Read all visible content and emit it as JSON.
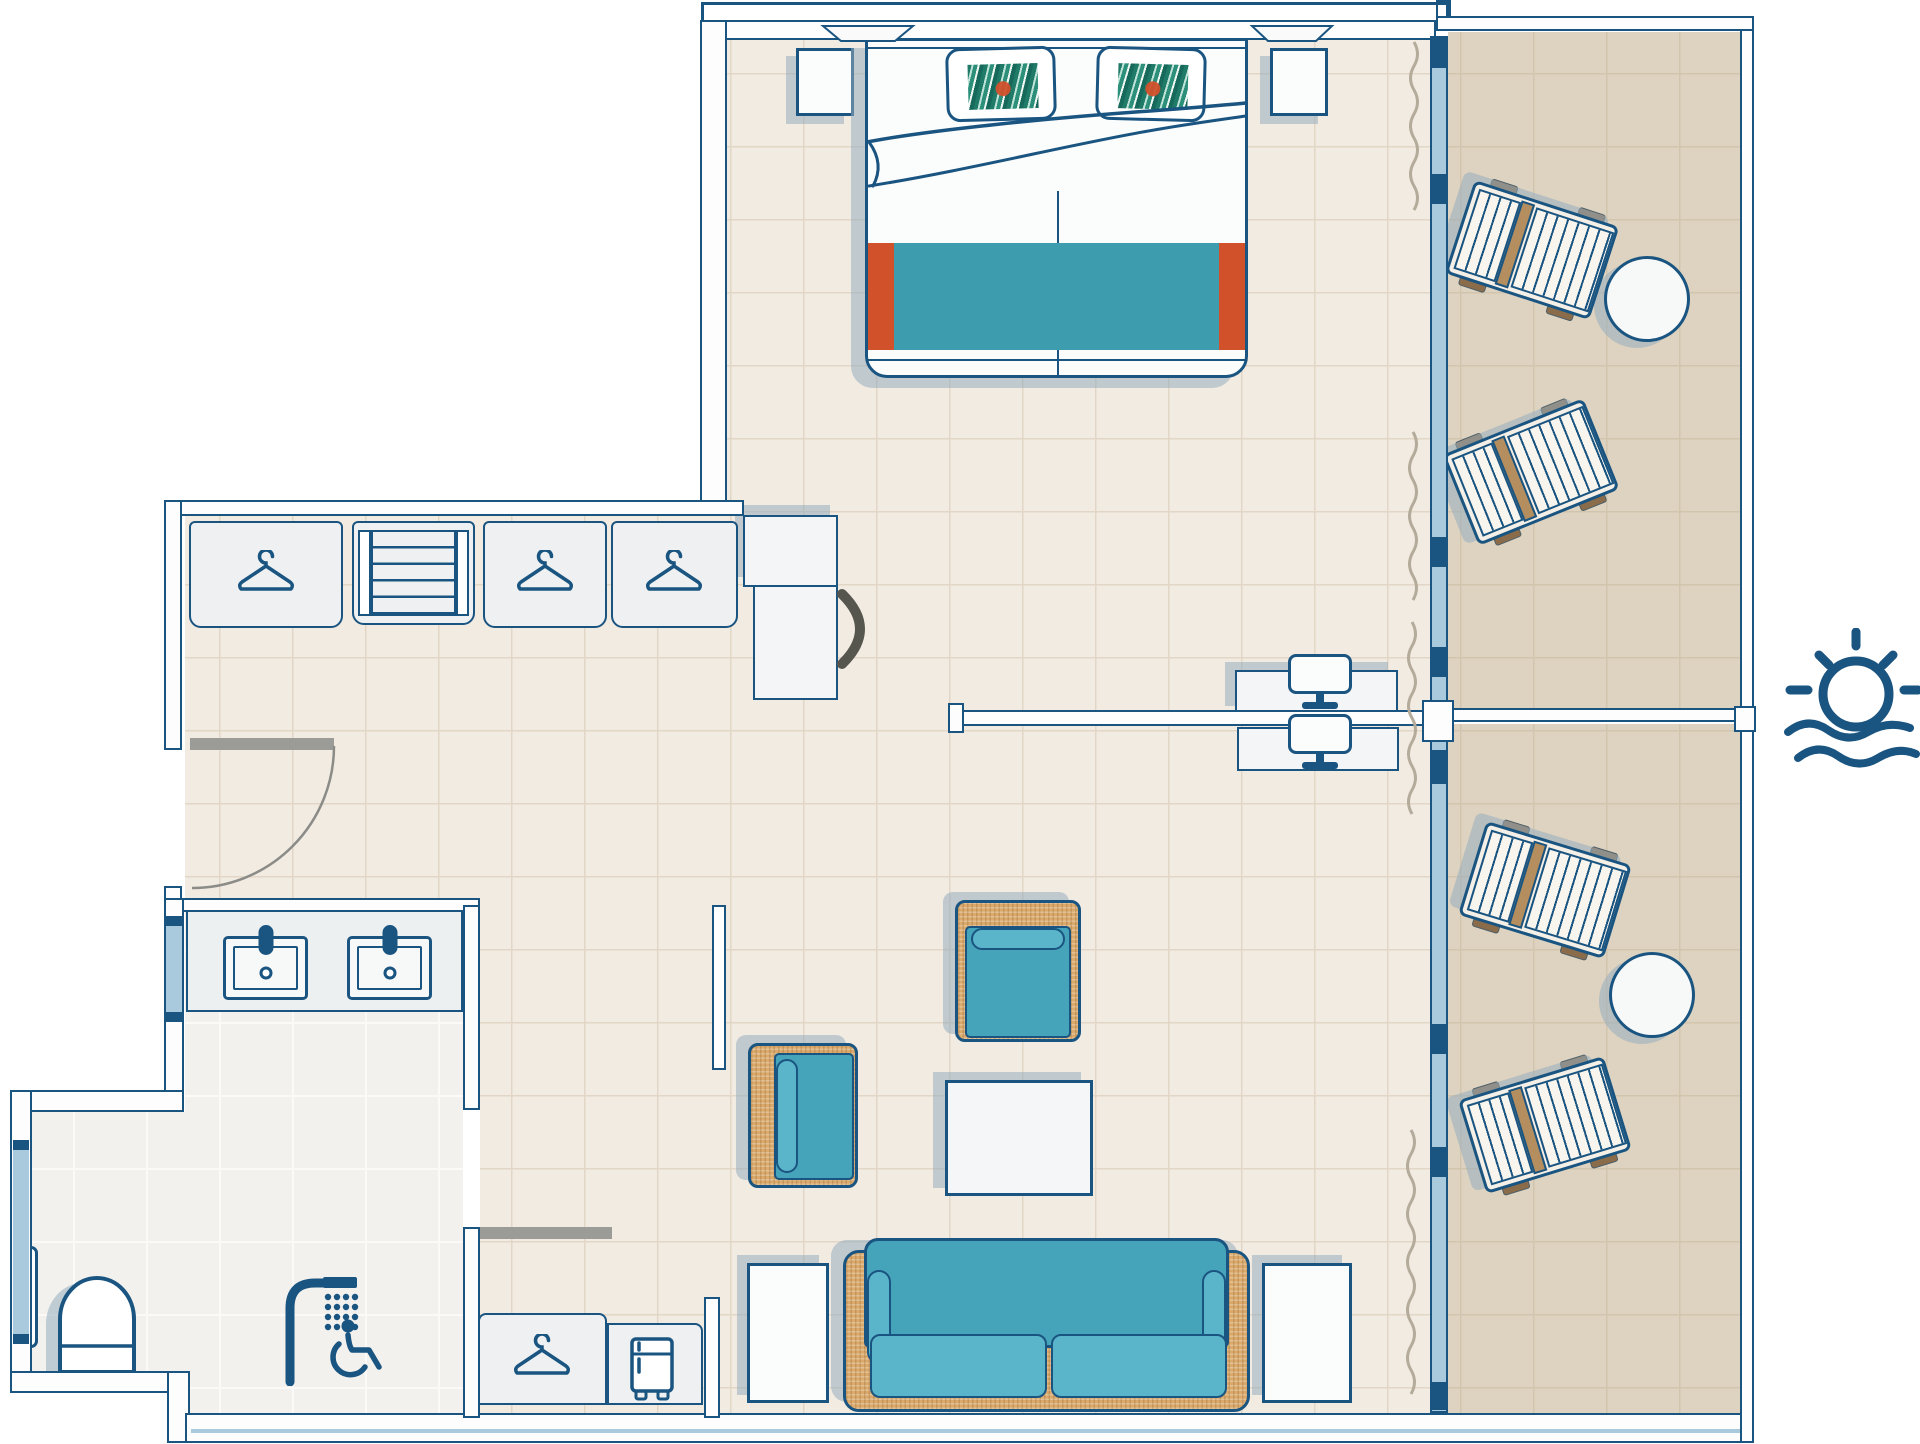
{
  "floor_plan": {
    "kind": "hotel suite floor plan - accessible room with sea view balcony",
    "visible_text": [],
    "colors": {
      "outline": "#1a5480",
      "wall_fill": "#fdfdfd",
      "glass": "#a9cadd",
      "room_floor": "#f2ebe2",
      "balcony_floor": "#ded3c0",
      "bathroom_floor": "#f2f1ee",
      "teal": "#45a3ba",
      "teal_light": "#5bb5ca",
      "bed_runner": "#3d9dae",
      "accent_orange": "#d1512b",
      "rattan": "#daa96b",
      "wood": "#8a6b4a",
      "shadow": "rgba(150,173,189,0.55)",
      "door_gray": "#9b9b97",
      "curtain": "#b5ab9b"
    },
    "rooms": [
      {
        "id": "bedroom",
        "label": "Bedroom",
        "items": [
          "double bed",
          "tropical print pillow x2",
          "folded duvet",
          "teal bed runner with orange trim",
          "nightstand x2",
          "TV sideboard",
          "wall TV",
          "curtain"
        ]
      },
      {
        "id": "dressing-corridor",
        "label": "Entrance corridor with wardrobe",
        "items": [
          "wardrobe hanger compartment x3",
          "open shelf unit",
          "entrance door with swing arc"
        ]
      },
      {
        "id": "bathroom",
        "label": "Accessible bathroom",
        "items": [
          "double vanity with two washbasins",
          "window",
          "roll-in shower",
          "wheelchair accessible sign",
          "sliding door"
        ]
      },
      {
        "id": "wc-niche",
        "label": "WC niche",
        "items": [
          "toilet",
          "grab bar",
          "window"
        ]
      },
      {
        "id": "living-area",
        "label": "Living area",
        "items": [
          "desk with two chairs",
          "partition stub",
          "armchair x2",
          "coffee table",
          "sofa",
          "side table x2",
          "hanger cabinet",
          "minibar fridge"
        ]
      },
      {
        "id": "balcony-upper",
        "label": "Balcony upper section",
        "items": [
          "sun lounger x2",
          "round table"
        ]
      },
      {
        "id": "balcony-lower",
        "label": "Balcony lower section",
        "items": [
          "sun lounger x2",
          "round table"
        ]
      }
    ],
    "icons": [
      {
        "name": "hanger-icon",
        "count": 4
      },
      {
        "name": "shelf-icon",
        "count": 1
      },
      {
        "name": "sink-icon",
        "count": 2
      },
      {
        "name": "shower-icon",
        "count": 1
      },
      {
        "name": "wheelchair-icon",
        "count": 1
      },
      {
        "name": "toilet-icon",
        "count": 1
      },
      {
        "name": "grab-bar-icon",
        "count": 1
      },
      {
        "name": "fridge-icon",
        "count": 1
      },
      {
        "name": "chair-icon",
        "count": 2
      },
      {
        "name": "tv-icon",
        "count": 1
      },
      {
        "name": "sun-over-sea-icon",
        "count": 1
      }
    ],
    "labels": {
      "double_bed": "Double bed",
      "pillow": "Tropical print pillow",
      "nightstand": "Nightstand",
      "tv_sideboard": "TV sideboard",
      "tv": "TV",
      "wardrobe_hanger": "Wardrobe compartment with hanger",
      "shelf_unit": "Open shelf unit",
      "entrance_door": "Entrance door",
      "vanity": "Double washbasin vanity",
      "sink": "Washbasin",
      "bath_window": "Bathroom window",
      "shower": "Roll-in shower",
      "wheelchair": "Wheelchair accessible",
      "toilet": "WC",
      "grab_bar": "Grab bar",
      "sliding_door": "Sliding bathroom door",
      "desk": "Desk",
      "chair": "Chair",
      "partition": "Partition",
      "armchair": "Armchair",
      "coffee_table": "Coffee table",
      "sofa": "Sofa",
      "side_table": "Side table",
      "hanger_cabinet": "Hanger cabinet",
      "minibar": "Minibar fridge",
      "glass_wall": "Floor-to-ceiling window front",
      "curtain": "Curtain",
      "balcony_divider": "Balcony divider",
      "sun_lounger": "Sun lounger",
      "round_table": "Round balcony table",
      "sea_view": "Sea view",
      "wc_window": "WC window"
    }
  }
}
